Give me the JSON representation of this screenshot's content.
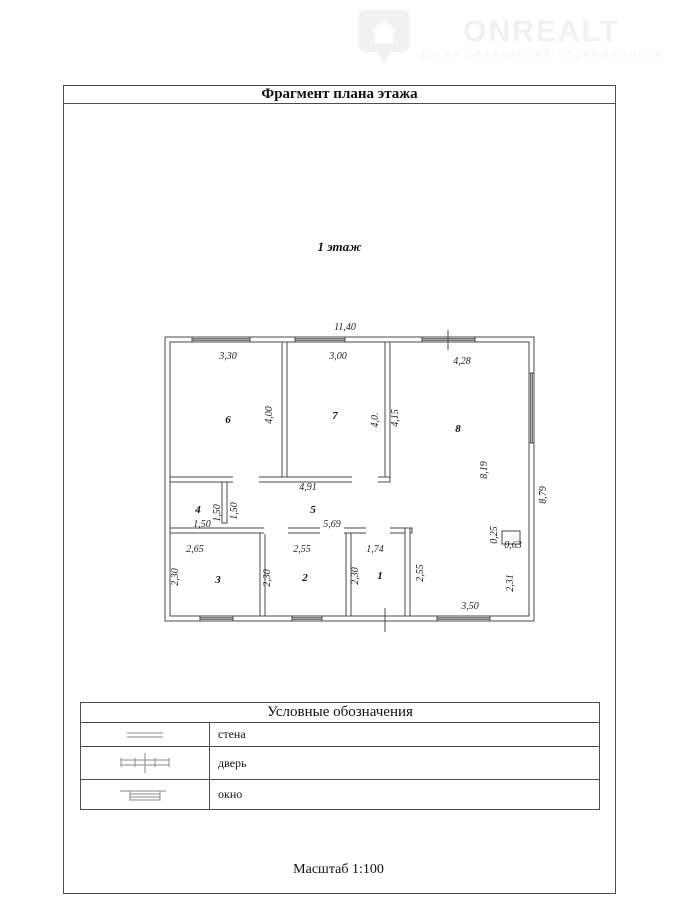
{
  "watermark": {
    "brand": "ONREALT",
    "tagline": "ДОСКА ОБЪЯВЛЕНИЙ НЕДВИЖИМОСТИ"
  },
  "header": {
    "title": "Фрагмент плана этажа"
  },
  "plan": {
    "floor_label": "1 этаж",
    "rooms": {
      "r1": "1",
      "r2": "2",
      "r3": "3",
      "r4": "4",
      "r5": "5",
      "r6": "6",
      "r7": "7",
      "r8": "8"
    },
    "dims": {
      "total_width": "11,40",
      "r6_width": "3,30",
      "r7_width": "3,00",
      "r8_width": "4,28",
      "r6_height": "4,00",
      "r7_height": "4,0.",
      "r7_height_right": "4,15",
      "r8_height": "8,19",
      "total_height": "8,79",
      "hall_top": "4,91",
      "hall_bottom": "5,69",
      "r4_width": "1,50",
      "r4_inner": "1,50",
      "r4_height": "1,50",
      "r3_width": "2,65",
      "r2_width": "2,55",
      "r1_width": "1,74",
      "r3_height": "2,30",
      "r2_height": "2,30",
      "r1_height": "2,30",
      "right_hall_height": "2,55",
      "niche_depth": "0,25",
      "niche_width": "0,63",
      "right_bottom_height": "2,31",
      "bottom_right_width": "3,50"
    }
  },
  "legend": {
    "title": "Условные обозначения",
    "rows": [
      {
        "label": "стена"
      },
      {
        "label": "дверь"
      },
      {
        "label": "окно"
      }
    ]
  },
  "footer": {
    "scale": "Масштаб 1:100"
  }
}
